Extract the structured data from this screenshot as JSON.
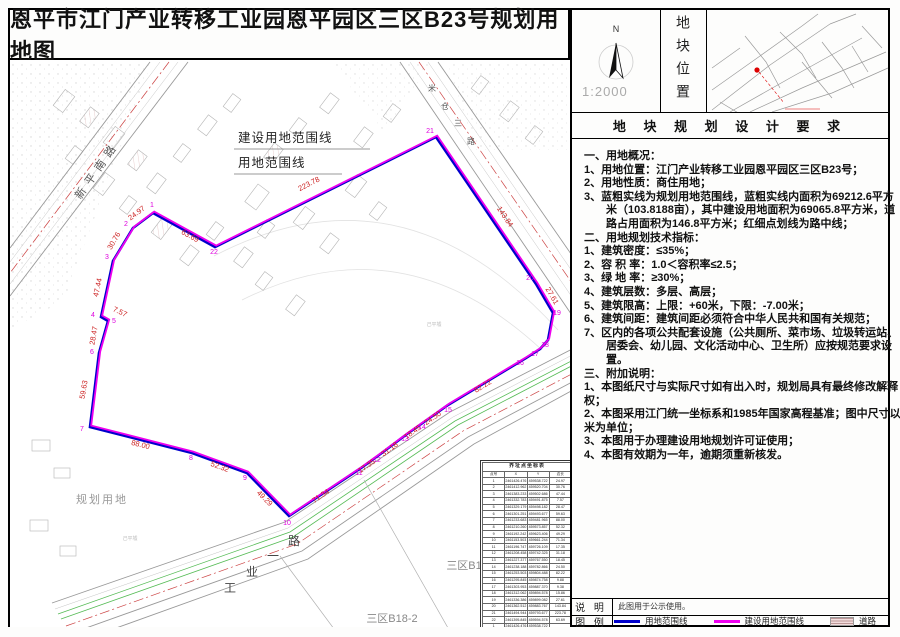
{
  "page": {
    "title": "恩平市江门产业转移工业园恩平园区三区B23号规划用地图"
  },
  "top_panel": {
    "north_label": "N",
    "scale": "1:2000",
    "section_title": "地块位置",
    "location_label": "地块位置"
  },
  "requirements": {
    "header": "地 块 规 划 设 计 要 求",
    "lines": [
      {
        "text": "一、用地概况：",
        "indent": 0
      },
      {
        "text": "1、用地位置：江门产业转移工业园恩平园区三区B23号；",
        "indent": 0
      },
      {
        "text": "2、用地性质：商住用地；",
        "indent": 0
      },
      {
        "text": "3、蓝粗实线为规划用地范围线，蓝粗实线内面积为69212.6平方",
        "indent": 0
      },
      {
        "text": "米（103.8188亩），其中建设用地面积为69065.8平方米，道",
        "indent": 1
      },
      {
        "text": "路占用面积为146.8平方米；红细点划线为路中线；",
        "indent": 1
      },
      {
        "text": "二、用地规划技术指标：",
        "indent": 0
      },
      {
        "text": "1、建筑密度：≤35%；",
        "indent": 0
      },
      {
        "text": "2、容 积 率：1.0＜容积率≤2.5；",
        "indent": 0
      },
      {
        "text": "3、绿 地 率：≥30%；",
        "indent": 0
      },
      {
        "text": "4、建筑层数：多层、高层；",
        "indent": 0
      },
      {
        "text": "5、建筑限高：上限：+60米，下限：-7.00米；",
        "indent": 0
      },
      {
        "text": "6、建筑间距：建筑间距必须符合中华人民共和国有关规范；",
        "indent": 0
      },
      {
        "text": "7、区内的各项公共配套设施（公共厕所、菜市场、垃圾转运站、",
        "indent": 0
      },
      {
        "text": "居委会、幼儿园、文化活动中心、卫生所）应按规范要求设",
        "indent": 1
      },
      {
        "text": "置。",
        "indent": 1
      },
      {
        "text": "三、附加说明：",
        "indent": 0
      },
      {
        "text": "1、本图纸尺寸与实际尺寸如有出入时，规划局具有最终修改解释",
        "indent": 0
      },
      {
        "text": "权；",
        "indent": 0
      },
      {
        "text": "2、本图采用江门统一坐标系和1985年国家高程基准；图中尺寸以",
        "indent": 0
      },
      {
        "text": "米为单位；",
        "indent": 0
      },
      {
        "text": "3、本图用于办理建设用地规划许可证使用；",
        "indent": 0
      },
      {
        "text": "4、本图有效期为一年，逾期须重新核发。",
        "indent": 0
      }
    ]
  },
  "legend": {
    "note_label": "说 明",
    "note_text": "此图用于公示使用。",
    "legend_label": "图 例",
    "items": [
      {
        "label": "用地范围线",
        "type": "blue-line"
      },
      {
        "label": "建设用地范围线",
        "type": "magenta-line"
      },
      {
        "label": "道路",
        "type": "road"
      }
    ]
  },
  "colors": {
    "boundary_blue": "#0000cc",
    "boundary_magenta": "#ee00ee",
    "dim_red": "#cc2222",
    "point_magenta": "#dd00dd",
    "centerline_red": "#cc4444",
    "green_line": "#55bb55"
  },
  "map": {
    "boundary_labels": [
      {
        "t": "建设用地范围线",
        "x": 236,
        "y": 142,
        "ux1": 232,
        "ux2": 368,
        "uy": 149
      },
      {
        "t": "用地范围线",
        "x": 236,
        "y": 167,
        "ux1": 232,
        "ux2": 340,
        "uy": 174
      }
    ],
    "dim_labels": [
      {
        "t": "24.97",
        "x": 136,
        "y": 215,
        "r": -37
      },
      {
        "t": "30.76",
        "x": 114,
        "y": 242,
        "r": -60
      },
      {
        "t": "47.44",
        "x": 98,
        "y": 288,
        "r": -78
      },
      {
        "t": "7.57",
        "x": 117,
        "y": 314,
        "r": 25
      },
      {
        "t": "28.47",
        "x": 94,
        "y": 336,
        "r": -80
      },
      {
        "t": "59.63",
        "x": 84,
        "y": 390,
        "r": -80
      },
      {
        "t": "88.00",
        "x": 138,
        "y": 447,
        "r": 14
      },
      {
        "t": "52.32",
        "x": 217,
        "y": 469,
        "r": 20
      },
      {
        "t": "49.29",
        "x": 261,
        "y": 500,
        "r": 45
      },
      {
        "t": "71.34",
        "x": 320,
        "y": 498,
        "r": -34
      },
      {
        "t": "17.35",
        "x": 366,
        "y": 468,
        "r": -35
      },
      {
        "t": "31.18",
        "x": 389,
        "y": 451,
        "r": -37
      },
      {
        "t": "18.45",
        "x": 412,
        "y": 434,
        "r": -35
      },
      {
        "t": "24.50",
        "x": 432,
        "y": 420,
        "r": -35
      },
      {
        "t": "82.22",
        "x": 482,
        "y": 388,
        "r": -31
      },
      {
        "t": "27.61",
        "x": 548,
        "y": 297,
        "r": 60
      },
      {
        "t": "143.84",
        "x": 501,
        "y": 218,
        "r": 56
      },
      {
        "t": "223.78",
        "x": 308,
        "y": 186,
        "r": -27
      },
      {
        "t": "63.69",
        "x": 187,
        "y": 238,
        "r": 29
      }
    ],
    "point_labels": [
      {
        "n": "1",
        "x": 150,
        "y": 207
      },
      {
        "n": "2",
        "x": 124,
        "y": 226
      },
      {
        "n": "3",
        "x": 105,
        "y": 259
      },
      {
        "n": "4",
        "x": 91,
        "y": 317
      },
      {
        "n": "5",
        "x": 112,
        "y": 323
      },
      {
        "n": "6",
        "x": 90,
        "y": 354
      },
      {
        "n": "7",
        "x": 80,
        "y": 431
      },
      {
        "n": "8",
        "x": 189,
        "y": 460
      },
      {
        "n": "9",
        "x": 243,
        "y": 480
      },
      {
        "n": "10",
        "x": 285,
        "y": 525
      },
      {
        "n": "11",
        "x": 357,
        "y": 475
      },
      {
        "n": "12",
        "x": 375,
        "y": 462
      },
      {
        "n": "13",
        "x": 403,
        "y": 441
      },
      {
        "n": "14",
        "x": 420,
        "y": 429
      },
      {
        "n": "15",
        "x": 446,
        "y": 412
      },
      {
        "n": "16",
        "x": 518,
        "y": 365
      },
      {
        "n": "17",
        "x": 533,
        "y": 356
      },
      {
        "n": "18",
        "x": 543,
        "y": 347
      },
      {
        "n": "19",
        "x": 555,
        "y": 315
      },
      {
        "n": "20",
        "x": 528,
        "y": 280
      },
      {
        "n": "21",
        "x": 428,
        "y": 133
      },
      {
        "n": "22",
        "x": 212,
        "y": 254
      }
    ],
    "road_names": [
      {
        "t": "新平南路",
        "x": 98,
        "y": 172,
        "r": -55,
        "s": 11,
        "ls": 6,
        "c": "#555"
      },
      {
        "t": "米",
        "x": 430,
        "y": 91,
        "r": 0,
        "s": 8,
        "c": "#555"
      },
      {
        "t": "仓",
        "x": 443,
        "y": 109,
        "r": 0,
        "s": 8,
        "c": "#555"
      },
      {
        "t": "三",
        "x": 456,
        "y": 126,
        "r": 0,
        "s": 8,
        "c": "#555"
      },
      {
        "t": "路",
        "x": 469,
        "y": 144,
        "r": 0,
        "s": 8,
        "c": "#555"
      },
      {
        "t": "工",
        "x": 228,
        "y": 592,
        "r": 0,
        "s": 12,
        "c": "#444"
      },
      {
        "t": "业",
        "x": 250,
        "y": 576,
        "r": 0,
        "s": 12,
        "c": "#444"
      },
      {
        "t": "一",
        "x": 271,
        "y": 560,
        "r": 0,
        "s": 12,
        "c": "#444"
      },
      {
        "t": "路",
        "x": 292,
        "y": 545,
        "r": 0,
        "s": 12,
        "c": "#444"
      }
    ],
    "area_labels": [
      {
        "t": "规划用地",
        "x": 100,
        "y": 503,
        "s": 11,
        "c": "#999",
        "ls": 2
      },
      {
        "t": "三区B16-1",
        "x": 470,
        "y": 569,
        "s": 11,
        "c": "#888",
        "ls": 0
      },
      {
        "t": "三区B18-2",
        "x": 390,
        "y": 622,
        "s": 11,
        "c": "#888",
        "ls": 0
      },
      {
        "t": "己平墟",
        "x": 128,
        "y": 540,
        "s": 5,
        "c": "#bbb",
        "ls": 0
      },
      {
        "t": "己平墟",
        "x": 432,
        "y": 326,
        "s": 5,
        "c": "#bbb",
        "ls": 0
      }
    ]
  },
  "coord_table": {
    "title": "界址点坐标表",
    "headers": [
      "点号",
      "X",
      "Y",
      "边长"
    ],
    "rows": [
      [
        "1",
        "2461426.476",
        "459538.722",
        "24.97"
      ],
      [
        "2",
        "2461412.962",
        "459520.704",
        "30.76"
      ],
      [
        "3",
        "2461383.233",
        "459502.686",
        "47.44"
      ],
      [
        "4",
        "2461332.783",
        "459491.875",
        "7.57"
      ],
      [
        "5",
        "2461329.179",
        "459498.182",
        "28.47"
      ],
      [
        "6",
        "2461301.251",
        "459493.677",
        "59.63"
      ],
      [
        "7",
        "2461233.683",
        "459481.965",
        "88.00"
      ],
      [
        "8",
        "2461210.260",
        "459573.857",
        "52.32"
      ],
      [
        "9",
        "2461192.242",
        "459623.406",
        "49.29"
      ],
      [
        "10",
        "2461153.503",
        "459661.244",
        "71.34"
      ],
      [
        "11",
        "2461196.747",
        "459726.109",
        "17.35"
      ],
      [
        "12",
        "2461208.458",
        "459742.325",
        "31.18"
      ],
      [
        "13",
        "2461227.377",
        "459767.550",
        "18.45"
      ],
      [
        "14",
        "2461238.188",
        "459782.866",
        "24.50"
      ],
      [
        "15",
        "2461253.503",
        "459804.488",
        "82.22"
      ],
      [
        "16",
        "2461295.845",
        "459874.758",
        "9.88"
      ],
      [
        "17",
        "2461303.953",
        "459887.370",
        "9.38"
      ],
      [
        "18",
        "2461312.062",
        "459894.578",
        "15.86"
      ],
      [
        "19",
        "2461336.386",
        "459899.082",
        "27.61"
      ],
      [
        "20",
        "2461362.512",
        "459883.767",
        "143.84"
      ],
      [
        "21",
        "2461494.944",
        "459793.677",
        "223.78"
      ],
      [
        "22",
        "2461395.845",
        "459594.578",
        "63.69"
      ],
      [
        "1",
        "2461426.476",
        "459538.722",
        ""
      ]
    ],
    "footer": "S=69212.6平方米（103.8188亩）"
  }
}
